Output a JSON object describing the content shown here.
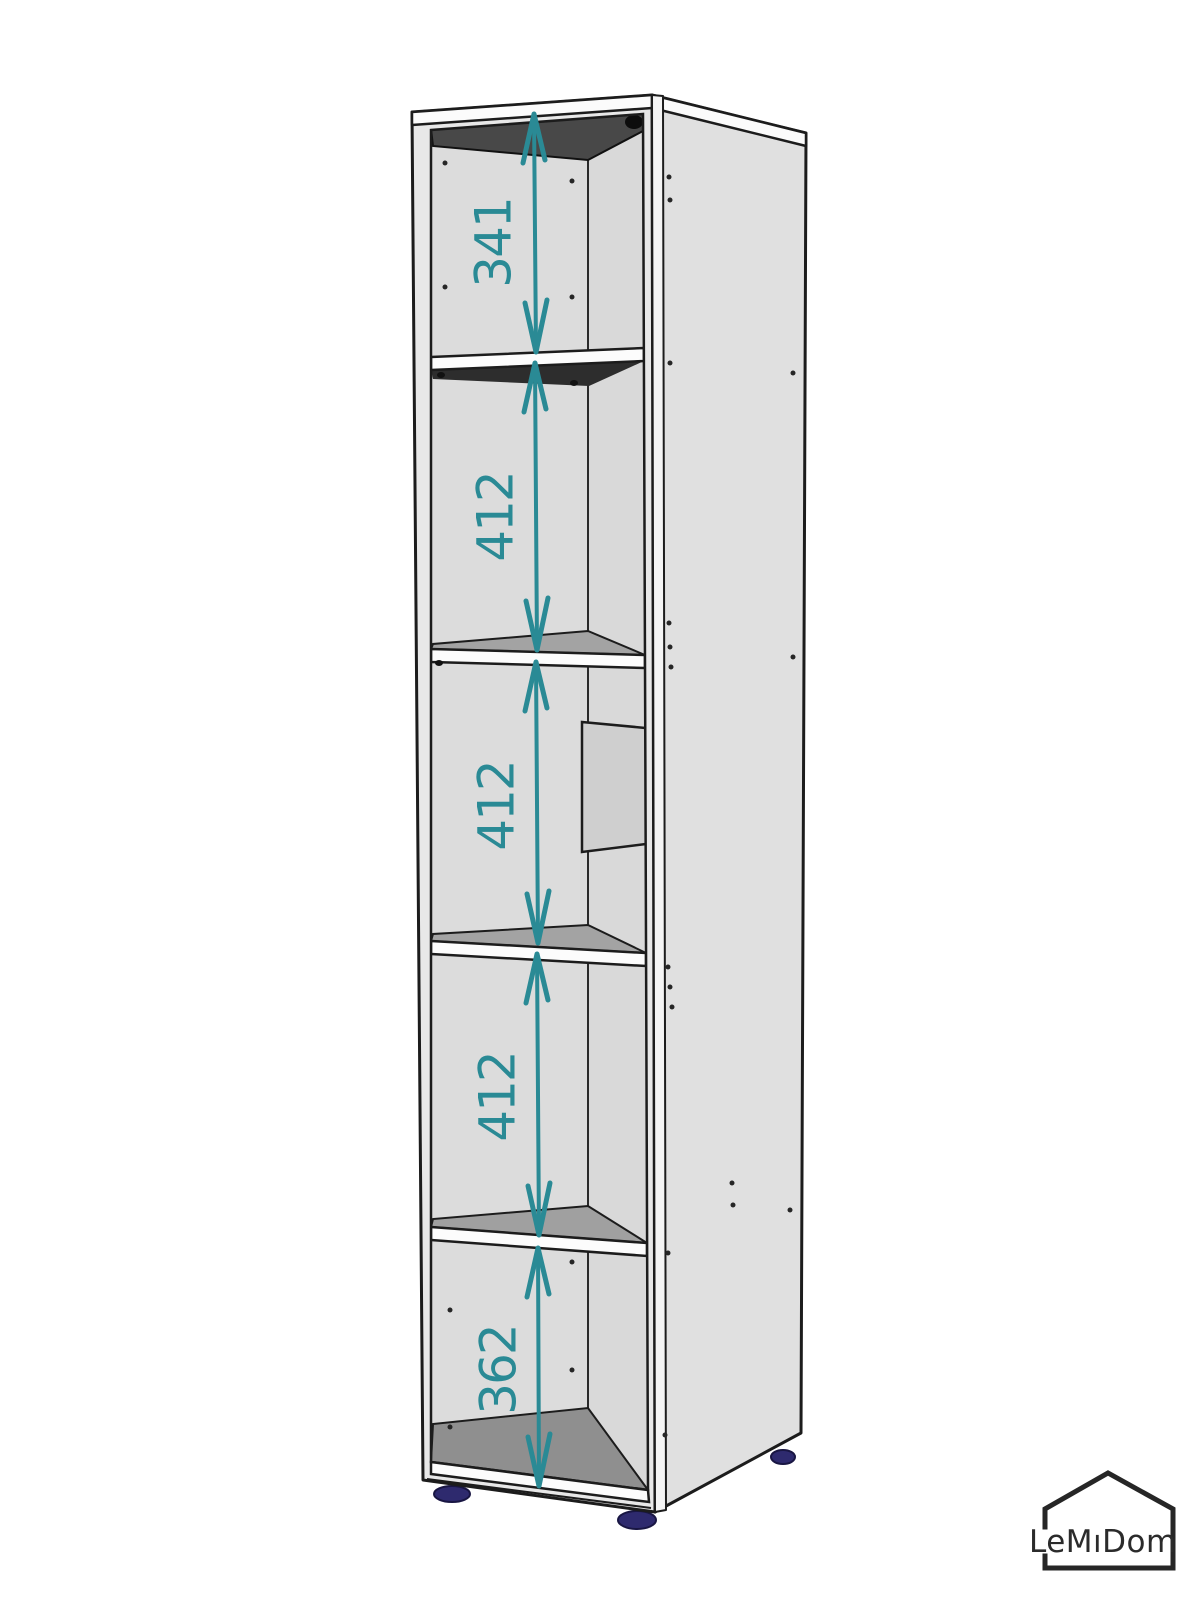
{
  "diagram": {
    "dimensions": [
      "341",
      "412",
      "412",
      "412",
      "362"
    ],
    "colors": {
      "accent": "#2a8a95",
      "feet": "#2e2a6e",
      "outline": "#1c1c1c"
    }
  },
  "logo": {
    "text": "LeMıDom"
  }
}
